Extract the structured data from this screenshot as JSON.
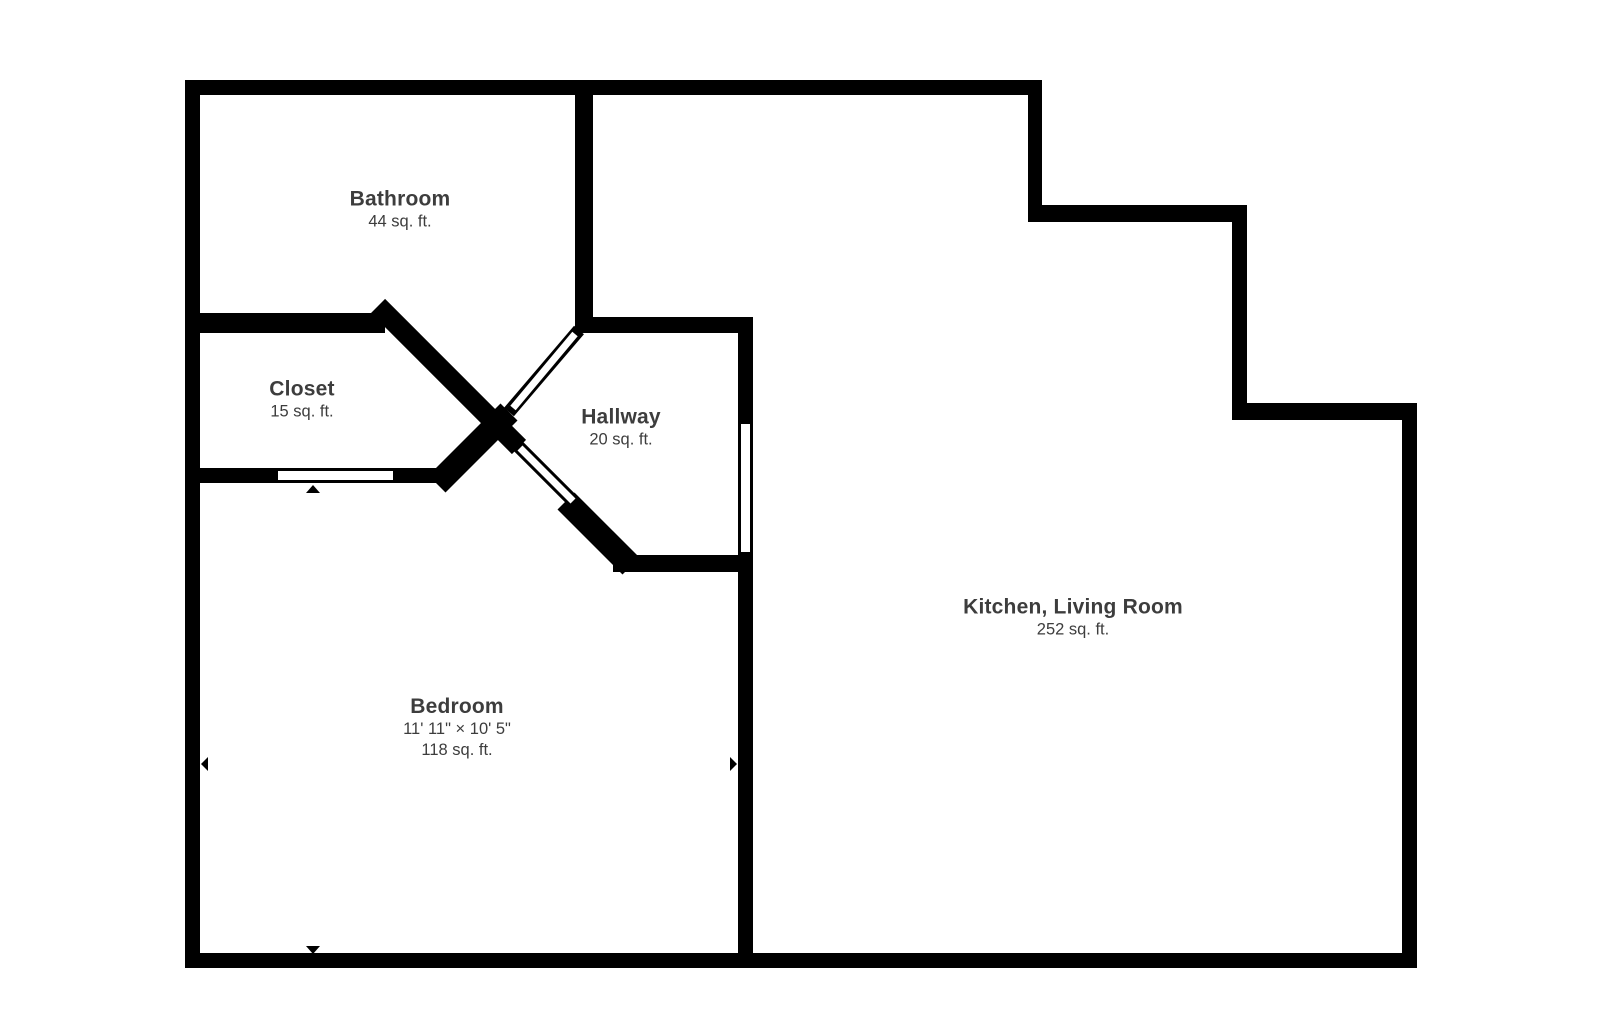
{
  "floorplan": {
    "background_color": "#ffffff",
    "wall_color": "#000000",
    "label_color": "#3d3d3d",
    "rooms": [
      {
        "id": "bathroom",
        "name": "Bathroom",
        "area": "44 sq. ft."
      },
      {
        "id": "closet",
        "name": "Closet",
        "area": "15 sq. ft."
      },
      {
        "id": "hallway",
        "name": "Hallway",
        "area": "20 sq. ft."
      },
      {
        "id": "bedroom",
        "name": "Bedroom",
        "dimensions": "11' 11\" × 10' 5\"",
        "area": "118 sq. ft."
      },
      {
        "id": "kitchen_living_room",
        "name": "Kitchen, Living Room",
        "area": "252 sq. ft."
      }
    ],
    "icons": [
      {
        "name": "dimension-arrow-up-icon"
      },
      {
        "name": "dimension-arrow-down-icon"
      },
      {
        "name": "dimension-arrow-left-icon"
      },
      {
        "name": "dimension-arrow-right-icon"
      }
    ]
  }
}
